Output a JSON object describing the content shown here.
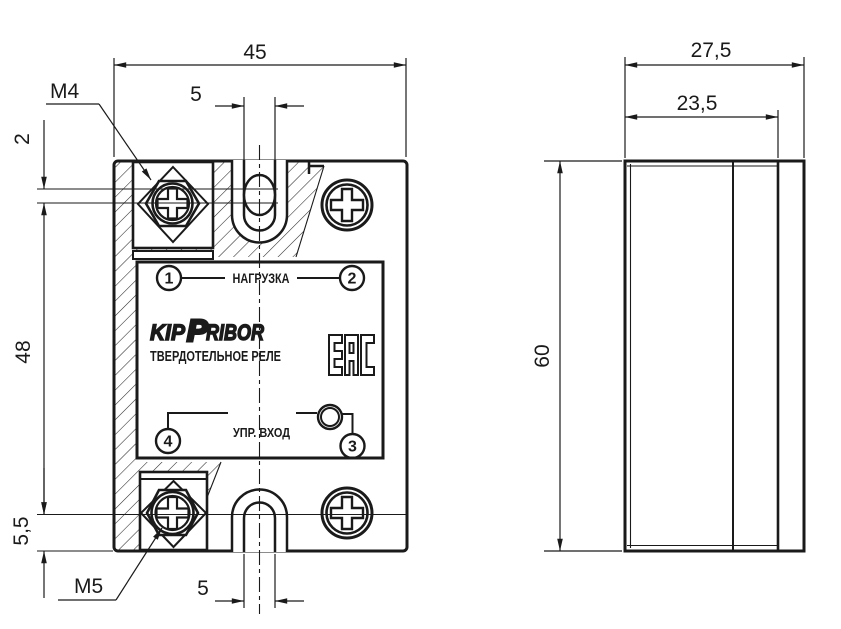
{
  "front_view": {
    "width_mm": "45",
    "top_slot_width": "5",
    "bottom_slot_width": "5",
    "top_edge_offset": "2",
    "mount_hole_spacing": "48",
    "bottom_edge_offset": "5,5",
    "top_terminal_thread": "M4",
    "bottom_terminal_thread": "M5",
    "label": {
      "terminal_1": "1",
      "terminal_2": "2",
      "terminal_3": "3",
      "terminal_4": "4",
      "load_text": "НАГРУЗКА",
      "control_text": "УПР. ВХОД",
      "brand_kip": "KIP",
      "brand_p": "P",
      "brand_ribor": "RIBOR",
      "product_text": "ТВЕРДОТЕЛЬНОЕ РЕЛЕ",
      "cert_mark": "EAC"
    }
  },
  "side_view": {
    "depth_mm": "27,5",
    "housing_depth_mm": "23,5",
    "height_mm": "60"
  },
  "colors": {
    "line": "#1a1a1a",
    "background": "#ffffff"
  }
}
